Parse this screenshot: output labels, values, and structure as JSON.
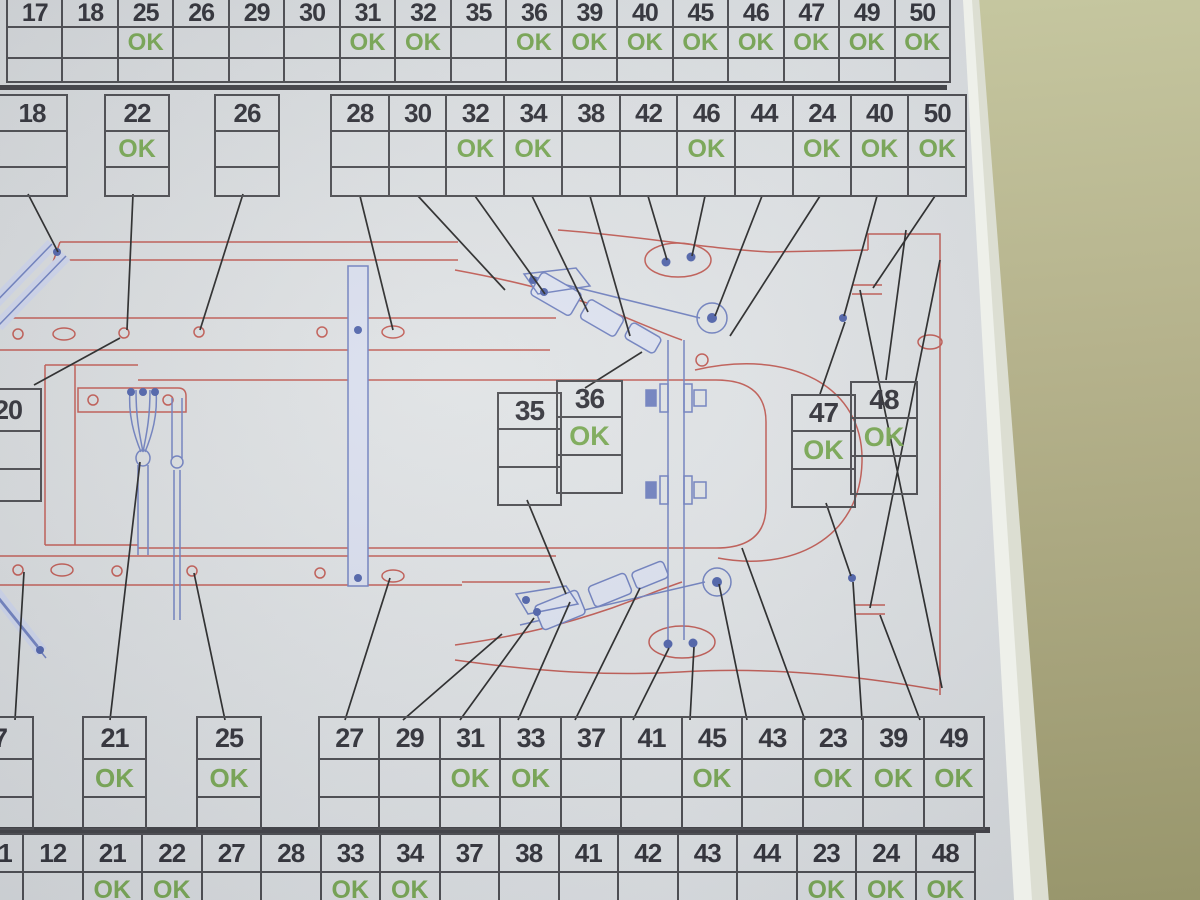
{
  "ok_label": "OK",
  "colors": {
    "paper": "#dee1e3",
    "wall": "#b0ae88",
    "grid_line": "#48484c",
    "number_ink": "#2d2d34",
    "ok_green": "#77a750",
    "diagram_red": "#bf574f",
    "diagram_blue": "#6c7dbd",
    "callout_black": "#232323"
  },
  "bands": {
    "top_row": {
      "cells": [
        {
          "label": "17",
          "ok": false
        },
        {
          "label": "18",
          "ok": false
        },
        {
          "label": "25",
          "ok": true
        },
        {
          "label": "26",
          "ok": false
        },
        {
          "label": "29",
          "ok": false
        },
        {
          "label": "30",
          "ok": false
        },
        {
          "label": "31",
          "ok": true
        },
        {
          "label": "32",
          "ok": true
        },
        {
          "label": "35",
          "ok": false
        },
        {
          "label": "36",
          "ok": true
        },
        {
          "label": "39",
          "ok": true
        },
        {
          "label": "40",
          "ok": true
        },
        {
          "label": "45",
          "ok": true
        },
        {
          "label": "46",
          "ok": true
        },
        {
          "label": "47",
          "ok": true
        },
        {
          "label": "49",
          "ok": true
        },
        {
          "label": "50",
          "ok": true
        }
      ]
    },
    "second_row": {
      "single_boxes": [
        {
          "label": "18",
          "ok": false
        },
        {
          "label": "22",
          "ok": true
        },
        {
          "label": "26",
          "ok": false
        }
      ],
      "group": [
        {
          "label": "28",
          "ok": false
        },
        {
          "label": "30",
          "ok": false
        },
        {
          "label": "32",
          "ok": true
        },
        {
          "label": "34",
          "ok": true
        },
        {
          "label": "38",
          "ok": false
        },
        {
          "label": "42",
          "ok": false
        },
        {
          "label": "46",
          "ok": true
        },
        {
          "label": "44",
          "ok": false
        },
        {
          "label": "24",
          "ok": true
        },
        {
          "label": "40",
          "ok": true
        },
        {
          "label": "50",
          "ok": true
        }
      ]
    },
    "middle": {
      "left_box": [
        {
          "label": "20",
          "ok": false
        }
      ],
      "pair_35_36": [
        {
          "label": "35",
          "ok": false
        },
        {
          "label": "36",
          "ok": true
        }
      ],
      "pair_47_48": [
        {
          "label": "47",
          "ok": true
        },
        {
          "label": "48",
          "ok": true
        }
      ]
    },
    "third_row": {
      "single_boxes": [
        {
          "label": "7",
          "ok": false
        },
        {
          "label": "21",
          "ok": true
        },
        {
          "label": "25",
          "ok": true
        }
      ],
      "group": [
        {
          "label": "27",
          "ok": false
        },
        {
          "label": "29",
          "ok": false
        },
        {
          "label": "31",
          "ok": true
        },
        {
          "label": "33",
          "ok": true
        },
        {
          "label": "37",
          "ok": false
        },
        {
          "label": "41",
          "ok": false
        },
        {
          "label": "45",
          "ok": true
        },
        {
          "label": "43",
          "ok": false
        },
        {
          "label": "23",
          "ok": true
        },
        {
          "label": "39",
          "ok": true
        },
        {
          "label": "49",
          "ok": true
        }
      ]
    },
    "bottom_row": {
      "cells": [
        {
          "label": "1",
          "ok": false
        },
        {
          "label": "12",
          "ok": false
        },
        {
          "label": "21",
          "ok": true
        },
        {
          "label": "22",
          "ok": true
        },
        {
          "label": "27",
          "ok": false
        },
        {
          "label": "28",
          "ok": false
        },
        {
          "label": "33",
          "ok": true
        },
        {
          "label": "34",
          "ok": true
        },
        {
          "label": "37",
          "ok": false
        },
        {
          "label": "38",
          "ok": false
        },
        {
          "label": "41",
          "ok": false
        },
        {
          "label": "42",
          "ok": false
        },
        {
          "label": "43",
          "ok": false
        },
        {
          "label": "44",
          "ok": false
        },
        {
          "label": "23",
          "ok": true
        },
        {
          "label": "24",
          "ok": true
        },
        {
          "label": "48",
          "ok": true
        }
      ]
    }
  }
}
